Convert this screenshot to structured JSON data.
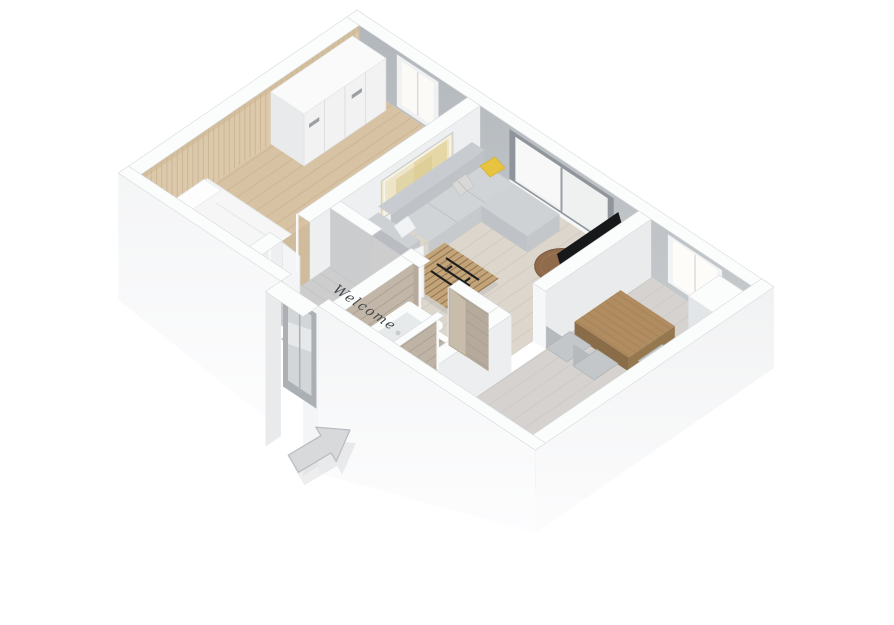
{
  "floorplan": {
    "welcome_text": "Welcome"
  },
  "colors": {
    "bg": "#ffffff",
    "wall-top": "#fbfcfc",
    "wall-inner-gray": "#b7bbbf",
    "wall-face-light": "#edeff0",
    "wood-slat": "#dcc9ab",
    "floor-bedroom": "#d7c3a4",
    "floor-living": "#dcd6cd",
    "floor-hall": "#cdcdce",
    "floor-dining": "#d5d2cf",
    "floor-bath": "#bdb4a8",
    "bath-wall-wood": "#c1b6a7",
    "sofa-gray": "#ced2d5",
    "accent-pillow": "#e7c33f",
    "side-table-wood": "#8f6a4b",
    "dining-table-wood": "#b08c60",
    "pallet-wood": "#c3a478",
    "tv-black": "#17181a",
    "fixture-white": "#fafbfb",
    "arrow-gray": "#d7d9db",
    "text-dark": "#44474a"
  }
}
